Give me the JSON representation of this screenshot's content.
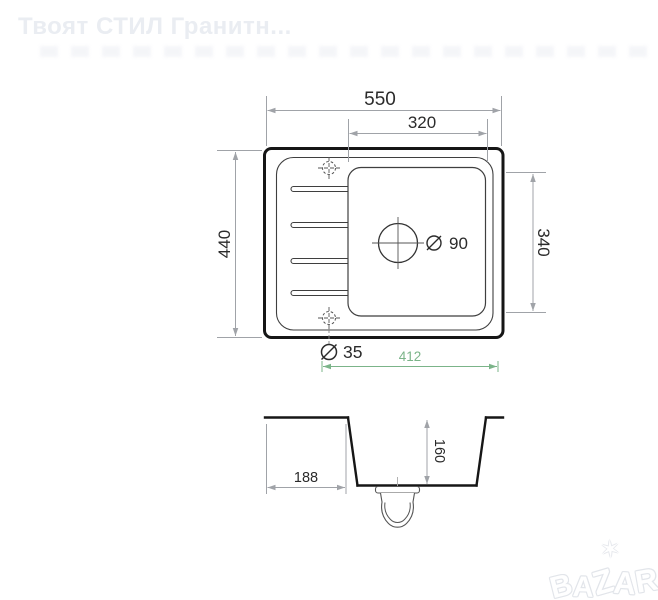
{
  "watermark": {
    "store_title": "Твоят СТИЛ Гранитн...",
    "logo_letters": [
      "B",
      "A",
      "Z",
      "A",
      "R"
    ],
    "logo_star_icon": "✶"
  },
  "dimensions": {
    "top_view": {
      "overall_width": "550",
      "basin_outer_width": "320",
      "overall_depth": "440",
      "basin_outer_depth": "340",
      "drain_hole_diameter": "90",
      "tap_hole_diameter": "35",
      "cutout_width": "412"
    },
    "section_view": {
      "basin_depth": "160",
      "drainer_width": "188"
    }
  },
  "colors": {
    "paper": "#ffffff",
    "outline_bold": "#161616",
    "line_thin": "#3f3f3f",
    "dimension_line": "#a0a3a8",
    "dimension_text": "#2b2b2b",
    "accent_green": "#7bb489",
    "watermark_gray": "#eaedf2"
  }
}
